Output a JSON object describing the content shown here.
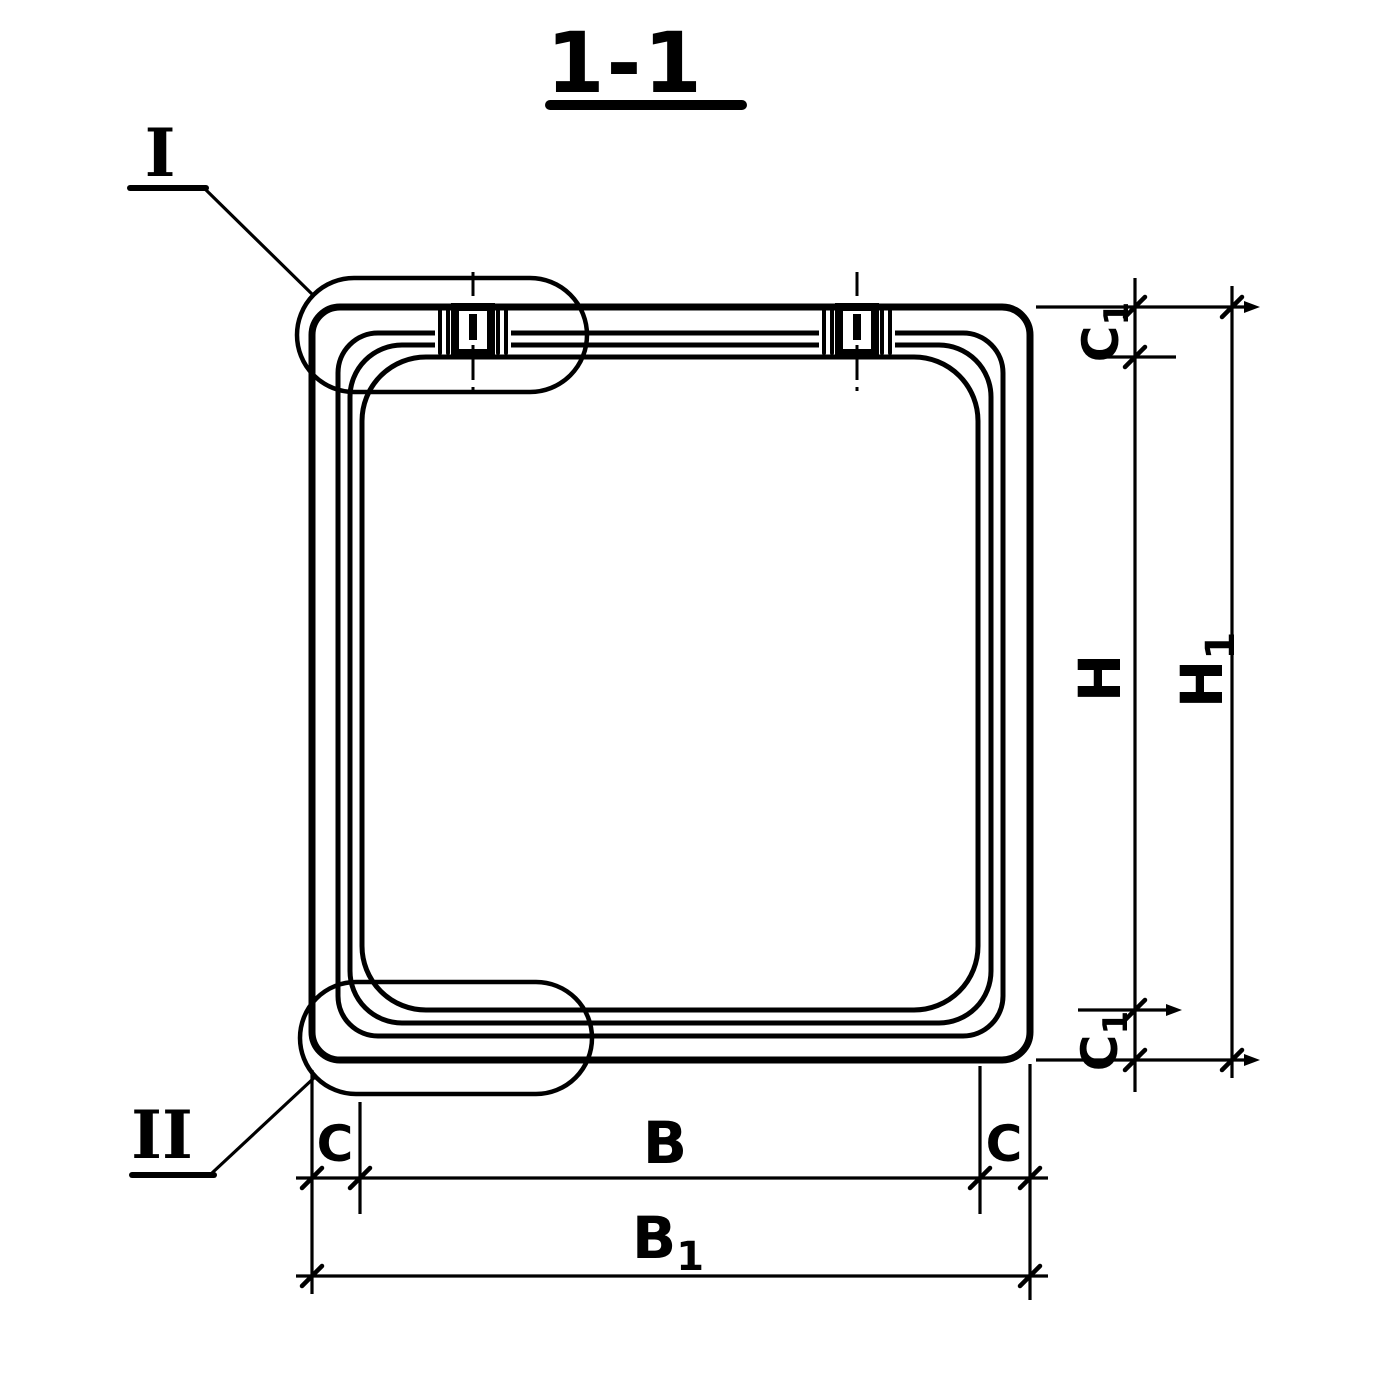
{
  "drawing": {
    "section_title": "1-1",
    "callouts": {
      "top": "I",
      "bottom": "II"
    },
    "dimensions": {
      "c1_top": {
        "base": "C",
        "sub": "1"
      },
      "h": {
        "base": "H",
        "sub": ""
      },
      "h1": {
        "base": "H",
        "sub": "1"
      },
      "c1_bottom": {
        "base": "C",
        "sub": "1"
      },
      "c_left": {
        "base": "C",
        "sub": ""
      },
      "b": {
        "base": "B",
        "sub": ""
      },
      "c_right": {
        "base": "C",
        "sub": ""
      },
      "b1": {
        "base": "B",
        "sub": "1"
      }
    },
    "colors": {
      "ink": "#000000",
      "paper": "#ffffff"
    }
  }
}
